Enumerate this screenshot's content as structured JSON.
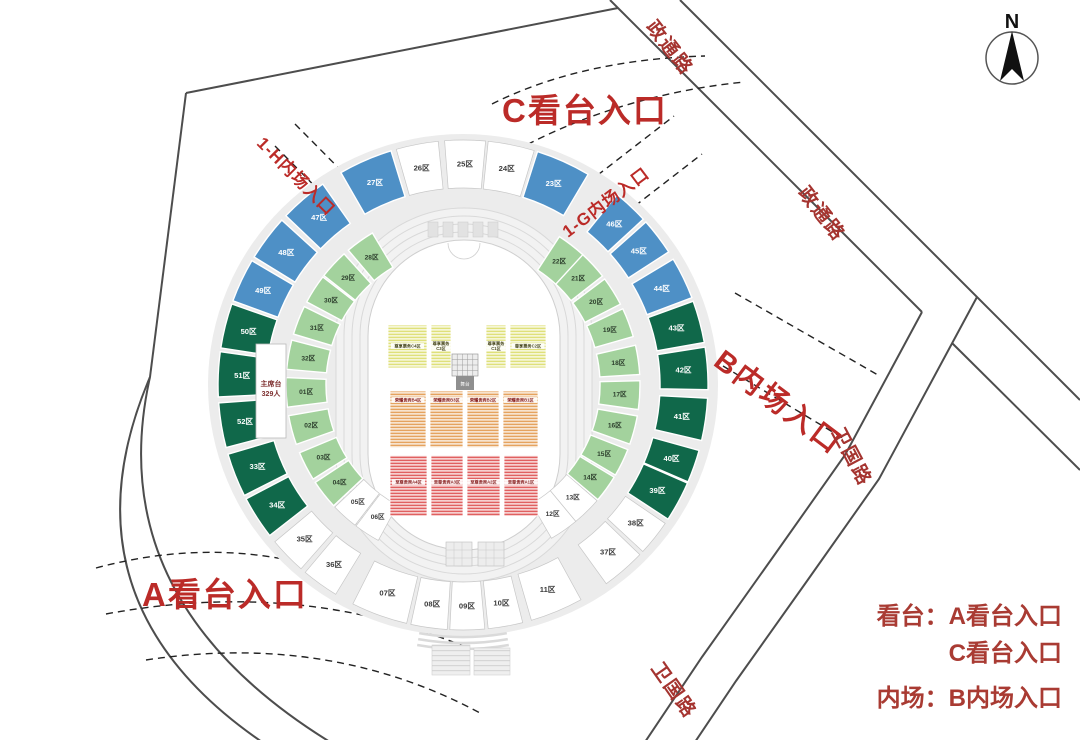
{
  "entrances": {
    "c": "C看台入口",
    "a": "A看台入口",
    "b": "B内场入口",
    "h1": "1-H内场入口",
    "g1": "1-G内场入口"
  },
  "roads": {
    "zhengtong_top": "政通路",
    "zhengtong_right": "政通路",
    "weiguo_right": "卫国路",
    "weiguo_bottom": "卫国路"
  },
  "compass": {
    "north": "N"
  },
  "legend": {
    "stands_line1": "看台：A看台入口",
    "stands_line2": "C看台入口",
    "infield_line1": "内场：B内场入口"
  },
  "rostrum": {
    "line1": "主席台",
    "line2": "329人"
  },
  "colors": {
    "accent_red": "#bb2b28",
    "road_label_red": "#a53430",
    "platform_gray": "#ececec",
    "road_line": "#4d4d4d",
    "section_fills": {
      "white": "#ffffff",
      "blue": "#4e90c6",
      "dgreen": "#10684a",
      "lgreen": "#a3d29d"
    },
    "section_text": {
      "white": "#3a3a3a",
      "blue": "#ffffff",
      "dgreen": "#ffffff",
      "lgreen": "#2c3e2c"
    },
    "stripe_yellow": "#dfe07a",
    "stripe_orange": "#e5a35f",
    "stripe_red": "#e06060",
    "strip_green": "#97cd8e"
  },
  "stadium": {
    "center": {
      "x": 463,
      "y": 385
    },
    "rings": {
      "outer": {
        "r1": 197,
        "r2": 245,
        "label_r": 221,
        "fs": 7.6
      },
      "inner": {
        "r1": 137,
        "r2": 177,
        "label_r": 157,
        "fs": 6.6
      }
    },
    "sections": [
      {
        "label": "25区",
        "ring": "outer",
        "a0": 265.7,
        "a1": 275.3,
        "color": "white"
      },
      {
        "label": "24区",
        "ring": "outer",
        "a0": 275.9,
        "a1": 286.9,
        "color": "white"
      },
      {
        "label": "23区",
        "ring": "outer",
        "a0": 287.7,
        "a1": 300.7,
        "color": "blue"
      },
      {
        "label": "46区",
        "ring": "outer",
        "a0": 309.0,
        "a1": 317.4,
        "color": "blue"
      },
      {
        "label": "45区",
        "ring": "outer",
        "a0": 318.3,
        "a1": 327.1,
        "color": "blue"
      },
      {
        "label": "44区",
        "ring": "outer",
        "a0": 329.1,
        "a1": 339.1,
        "color": "blue"
      },
      {
        "label": "43区",
        "ring": "outer",
        "a0": 340.0,
        "a1": 350.0,
        "color": "dgreen"
      },
      {
        "label": "42区",
        "ring": "outer",
        "a0": 351.1,
        "a1": 361.1,
        "color": "dgreen"
      },
      {
        "label": "41区",
        "ring": "outer",
        "a0": 3.1,
        "a1": 13.1,
        "color": "dgreen"
      },
      {
        "label": "40区",
        "ring": "outer",
        "a0": 15.5,
        "a1": 23.3,
        "color": "dgreen"
      },
      {
        "label": "39区",
        "ring": "outer",
        "a0": 23.6,
        "a1": 33.2,
        "color": "dgreen"
      },
      {
        "label": "38区",
        "ring": "outer",
        "a0": 34.4,
        "a1": 42.8,
        "color": "white"
      },
      {
        "label": "37区",
        "ring": "outer",
        "a0": 43.8,
        "a1": 54.2,
        "color": "white"
      },
      {
        "label": "11区",
        "ring": "outer",
        "a0": 61.2,
        "a1": 73.8,
        "color": "white"
      },
      {
        "label": "10区",
        "ring": "outer",
        "a0": 75.9,
        "a1": 84.1,
        "color": "white"
      },
      {
        "label": "09区",
        "ring": "outer",
        "a0": 84.9,
        "a1": 93.1,
        "color": "white"
      },
      {
        "label": "08区",
        "ring": "outer",
        "a0": 93.7,
        "a1": 102.3,
        "color": "white"
      },
      {
        "label": "07区",
        "ring": "outer",
        "a0": 103.3,
        "a1": 116.7,
        "color": "white"
      },
      {
        "label": "36区",
        "ring": "outer",
        "a0": 121.3,
        "a1": 130.1,
        "color": "white"
      },
      {
        "label": "35区",
        "ring": "outer",
        "a0": 131.4,
        "a1": 140.2,
        "color": "white"
      },
      {
        "label": "34区",
        "ring": "outer",
        "a0": 142.1,
        "a1": 152.3,
        "color": "dgreen"
      },
      {
        "label": "33区",
        "ring": "outer",
        "a0": 153.2,
        "a1": 163.6,
        "color": "dgreen"
      },
      {
        "label": "52区",
        "ring": "outer",
        "a0": 165.2,
        "a1": 175.8,
        "color": "dgreen"
      },
      {
        "label": "51区",
        "ring": "outer",
        "a0": 177.2,
        "a1": 187.8,
        "color": "dgreen"
      },
      {
        "label": "50区",
        "ring": "outer",
        "a0": 188.7,
        "a1": 199.3,
        "color": "dgreen"
      },
      {
        "label": "49区",
        "ring": "outer",
        "a0": 200.1,
        "a1": 210.5,
        "color": "blue"
      },
      {
        "label": "48区",
        "ring": "outer",
        "a0": 211.5,
        "a1": 222.3,
        "color": "blue"
      },
      {
        "label": "47区",
        "ring": "outer",
        "a0": 223.7,
        "a1": 235.1,
        "color": "blue"
      },
      {
        "label": "27区",
        "ring": "outer",
        "a0": 240.1,
        "a1": 252.9,
        "color": "blue"
      },
      {
        "label": "26区",
        "ring": "outer",
        "a0": 254.2,
        "a1": 264.2,
        "color": "white"
      },
      {
        "label": "28区",
        "ring": "inner",
        "a0": 229.6,
        "a1": 239.2,
        "color": "lgreen"
      },
      {
        "label": "29区",
        "ring": "inner",
        "a0": 218.2,
        "a1": 227.8,
        "color": "lgreen"
      },
      {
        "label": "30区",
        "ring": "inner",
        "a0": 208.0,
        "a1": 217.6,
        "color": "lgreen"
      },
      {
        "label": "31区",
        "ring": "inner",
        "a0": 196.7,
        "a1": 206.3,
        "color": "lgreen"
      },
      {
        "label": "32区",
        "ring": "inner",
        "a0": 185.1,
        "a1": 194.7,
        "color": "lgreen"
      },
      {
        "label": "01区",
        "ring": "inner",
        "a0": 172.8,
        "a1": 182.4,
        "color": "lgreen"
      },
      {
        "label": "02区",
        "ring": "inner",
        "a0": 160.4,
        "a1": 170.0,
        "color": "lgreen"
      },
      {
        "label": "03区",
        "ring": "inner",
        "a0": 147.9,
        "a1": 157.5,
        "color": "lgreen"
      },
      {
        "label": "04区",
        "ring": "inner",
        "a0": 137.0,
        "a1": 146.6,
        "color": "lgreen"
      },
      {
        "label": "05区",
        "ring": "inner",
        "a0": 127.6,
        "a1": 136.4,
        "color": "white"
      },
      {
        "label": "06区",
        "ring": "inner",
        "a0": 118.6,
        "a1": 127.2,
        "color": "white"
      },
      {
        "label": "12区",
        "ring": "inner",
        "a0": 50.4,
        "a1": 60.0,
        "color": "white"
      },
      {
        "label": "13区",
        "ring": "inner",
        "a0": 40.8,
        "a1": 50.4,
        "color": "white"
      },
      {
        "label": "14区",
        "ring": "inner",
        "a0": 31.4,
        "a1": 40.4,
        "color": "lgreen"
      },
      {
        "label": "15区",
        "ring": "inner",
        "a0": 21.4,
        "a1": 30.6,
        "color": "lgreen"
      },
      {
        "label": "16区",
        "ring": "inner",
        "a0": 10.1,
        "a1": 19.5,
        "color": "lgreen"
      },
      {
        "label": "17区",
        "ring": "inner",
        "a0": 358.6,
        "a1": 368.0,
        "color": "lgreen"
      },
      {
        "label": "18区",
        "ring": "inner",
        "a0": 347.0,
        "a1": 356.6,
        "color": "lgreen"
      },
      {
        "label": "19区",
        "ring": "inner",
        "a0": 334.5,
        "a1": 344.1,
        "color": "lgreen"
      },
      {
        "label": "20区",
        "ring": "inner",
        "a0": 323.2,
        "a1": 332.8,
        "color": "lgreen"
      },
      {
        "label": "21区",
        "ring": "inner",
        "a0": 312.4,
        "a1": 322.0,
        "color": "lgreen"
      },
      {
        "label": "22区",
        "ring": "inner",
        "a0": 303.0,
        "a1": 312.6,
        "color": "lgreen"
      }
    ]
  },
  "infield": {
    "stage_label": "舞台",
    "rows": [
      {
        "name": "yellow",
        "y0": 325,
        "y1": 368,
        "label_y": 346,
        "text_color": "#4a4a20",
        "pattern": "p-yellow",
        "blocks": [
          {
            "label": "尊享票务C4区",
            "x0": 388,
            "x1": 427,
            "two_line": false
          },
          {
            "label": "尊享票务C3区",
            "x0": 431,
            "x1": 451,
            "two_line": true
          },
          {
            "label": "尊享票务C1区",
            "x0": 486,
            "x1": 506,
            "two_line": true
          },
          {
            "label": "尊享票务C2区",
            "x0": 510,
            "x1": 546,
            "two_line": false
          }
        ]
      },
      {
        "name": "orange",
        "y0": 391,
        "y1": 448,
        "label_y": 400,
        "text_color": "#8a2222",
        "pattern": "p-orange",
        "blocks": [
          {
            "label": "荣耀贵宾B4区",
            "x0": 390,
            "x1": 426,
            "two_line": false
          },
          {
            "label": "荣耀贵宾B3区",
            "x0": 430,
            "x1": 463,
            "two_line": false
          },
          {
            "label": "荣耀贵宾B2区",
            "x0": 467,
            "x1": 499,
            "two_line": false
          },
          {
            "label": "荣耀贵宾B1区",
            "x0": 503,
            "x1": 538,
            "two_line": false
          }
        ]
      },
      {
        "name": "red",
        "y0": 455,
        "y1": 516,
        "label_y": 482,
        "text_color": "#8a2222",
        "pattern": "p-red",
        "blocks": [
          {
            "label": "至尊贵宾A4区",
            "x0": 390,
            "x1": 427,
            "two_line": false
          },
          {
            "label": "至尊贵宾A3区",
            "x0": 431,
            "x1": 463,
            "two_line": false
          },
          {
            "label": "至尊贵宾A2区",
            "x0": 467,
            "x1": 500,
            "two_line": false
          },
          {
            "label": "至尊贵宾A1区",
            "x0": 504,
            "x1": 538,
            "two_line": false
          }
        ]
      }
    ],
    "strips": {
      "y0": 501,
      "y1": 509,
      "label_y": 505.5,
      "text_color": "#1e5c1e",
      "blocks": [
        {
          "label": "内场贵宾A2区",
          "x0": 433,
          "x1": 461
        },
        {
          "label": "内场贵宾A1区",
          "x0": 467,
          "x1": 494
        }
      ]
    }
  }
}
